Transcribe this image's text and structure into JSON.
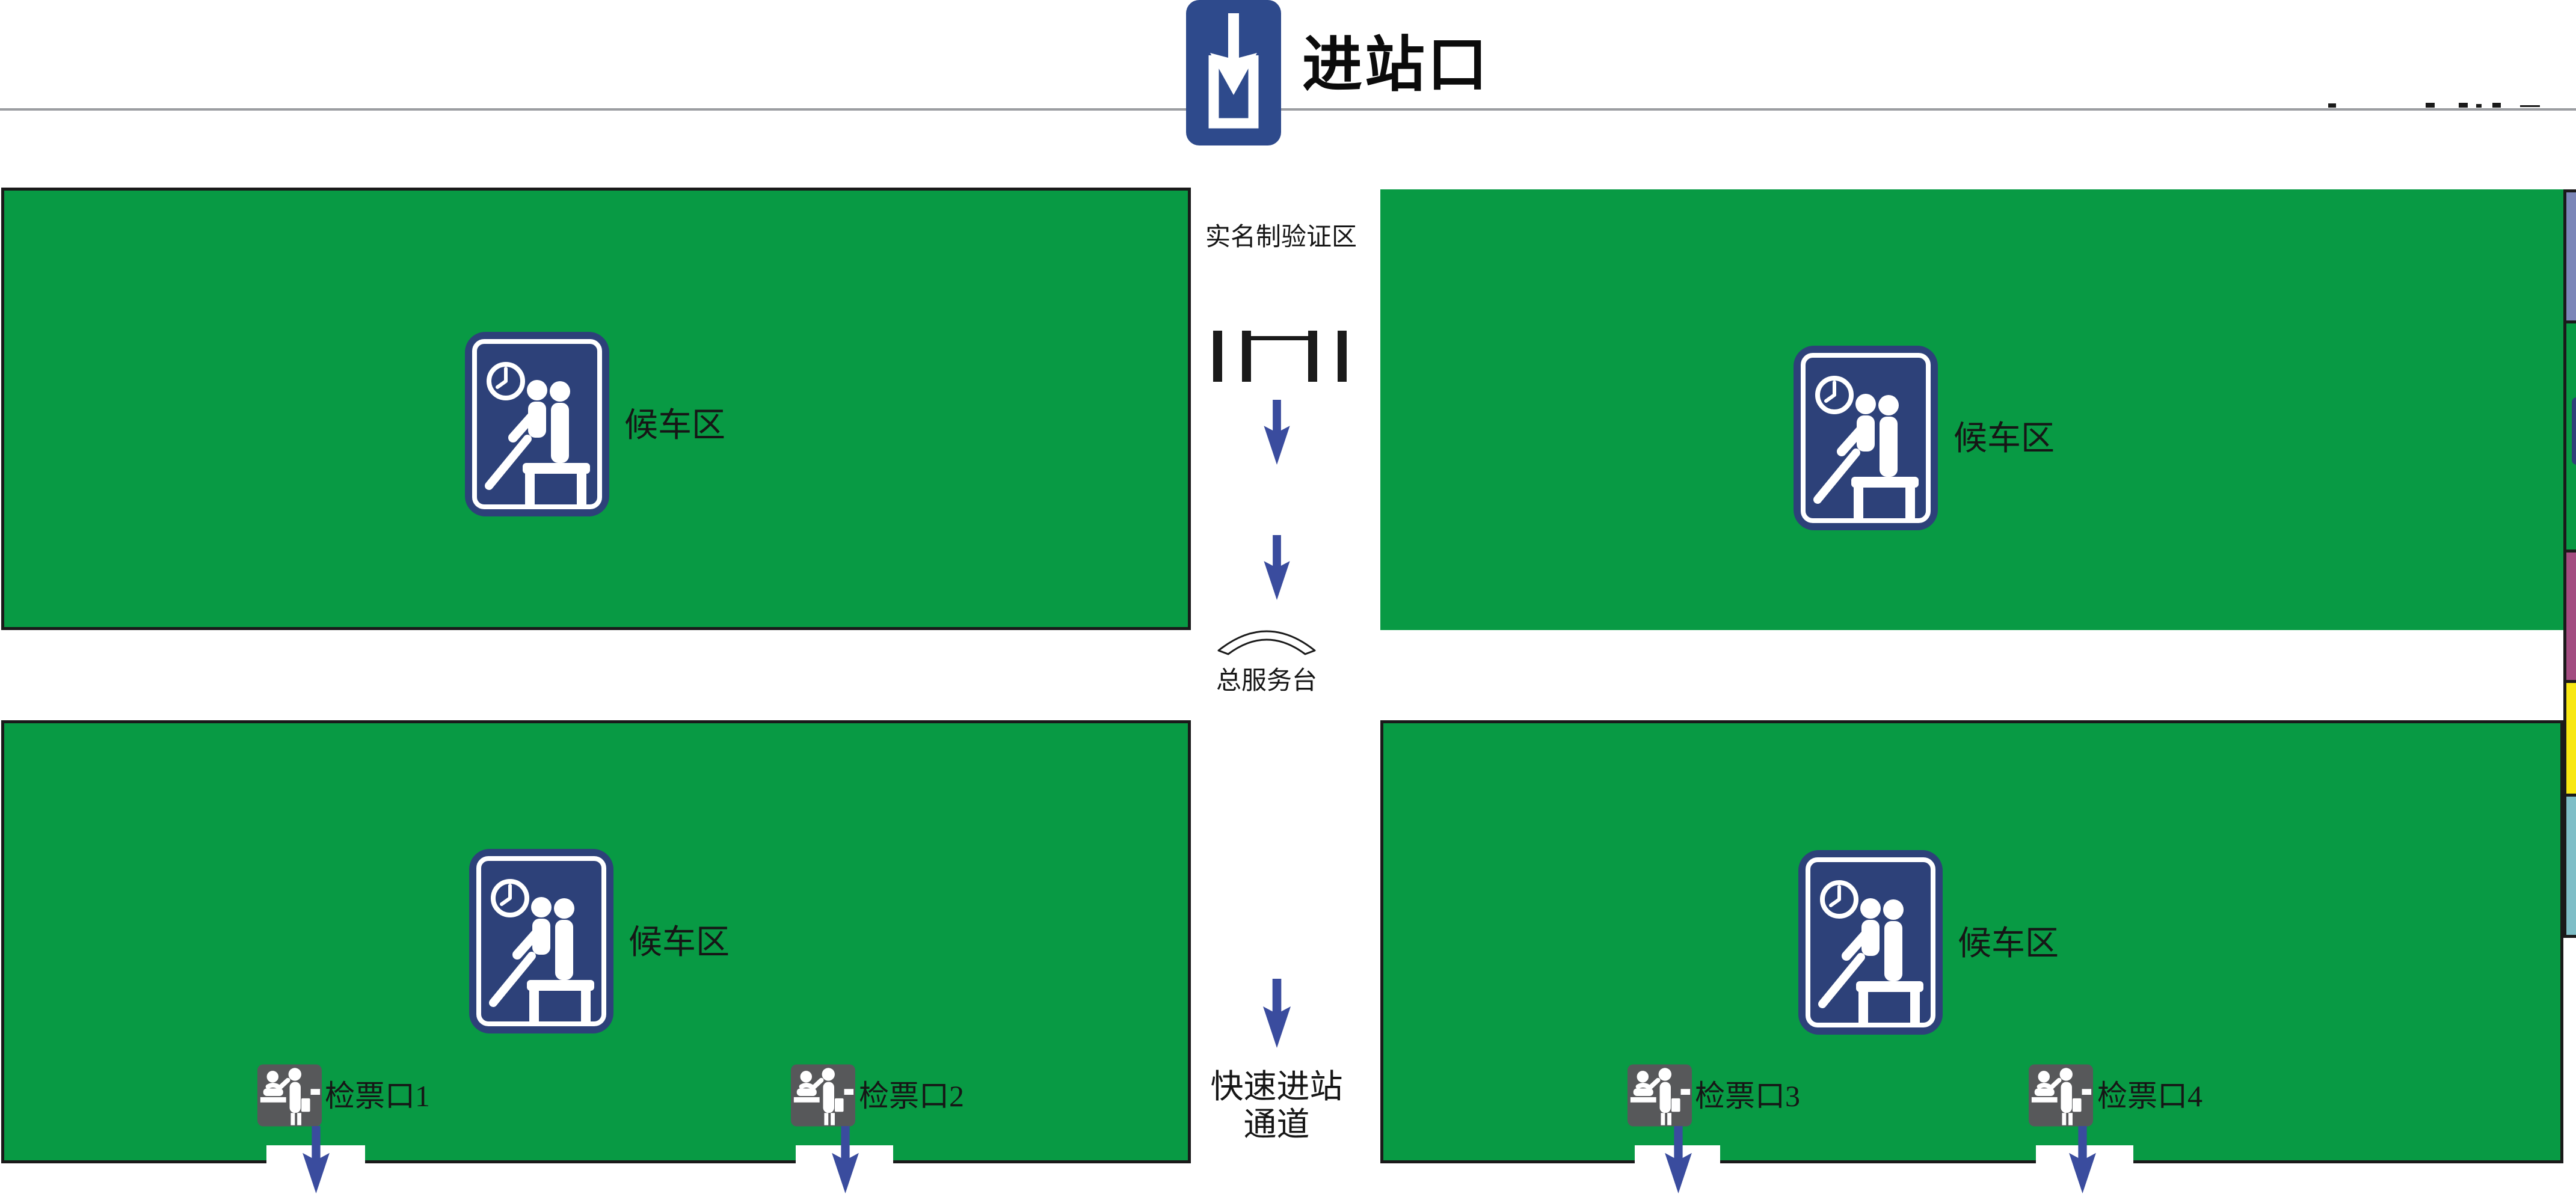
{
  "station_map": {
    "entrance": {
      "label": "进站口"
    },
    "verification_zone": {
      "label": "实名制验证区"
    },
    "service_desk": {
      "label": "总服务台"
    },
    "fast_entry_channel": {
      "line1": "快速进站",
      "line2": "通道"
    },
    "waiting_areas": [
      {
        "label": "候车区"
      },
      {
        "label": "候车区"
      },
      {
        "label": "候车区"
      },
      {
        "label": "候车区"
      }
    ],
    "ticket_gates": [
      {
        "label": "检票口1"
      },
      {
        "label": "检票口2"
      },
      {
        "label": "检票口3"
      },
      {
        "label": "检票口4"
      }
    ],
    "icons": {
      "entrance_icon": "entrance-arrow-into-tray-icon",
      "waiting_icon": "clock-and-seated-passengers-icon",
      "turnstile_icon": "security-gate-turnstile-icon",
      "service_desk_icon": "curved-counter-icon",
      "gate_icon": "ticket-inspector-and-passenger-icon",
      "flow_arrow_icon": "down-arrow"
    },
    "colors": {
      "zone_green": "#089A44",
      "sign_navy": "#2D4179",
      "entrance_navy": "#2E4A8C",
      "flow_arrow_blue": "#3A4C9E",
      "gate_icon_gray": "#57585A",
      "divider_gray": "#9B9DA1",
      "edge_strip_slate": "#7B86B8",
      "edge_strip_purple": "#A34C80",
      "edge_strip_yellow": "#F8E712",
      "edge_strip_teal": "#7FBEC7",
      "outline_black": "#1A1A1A"
    }
  }
}
